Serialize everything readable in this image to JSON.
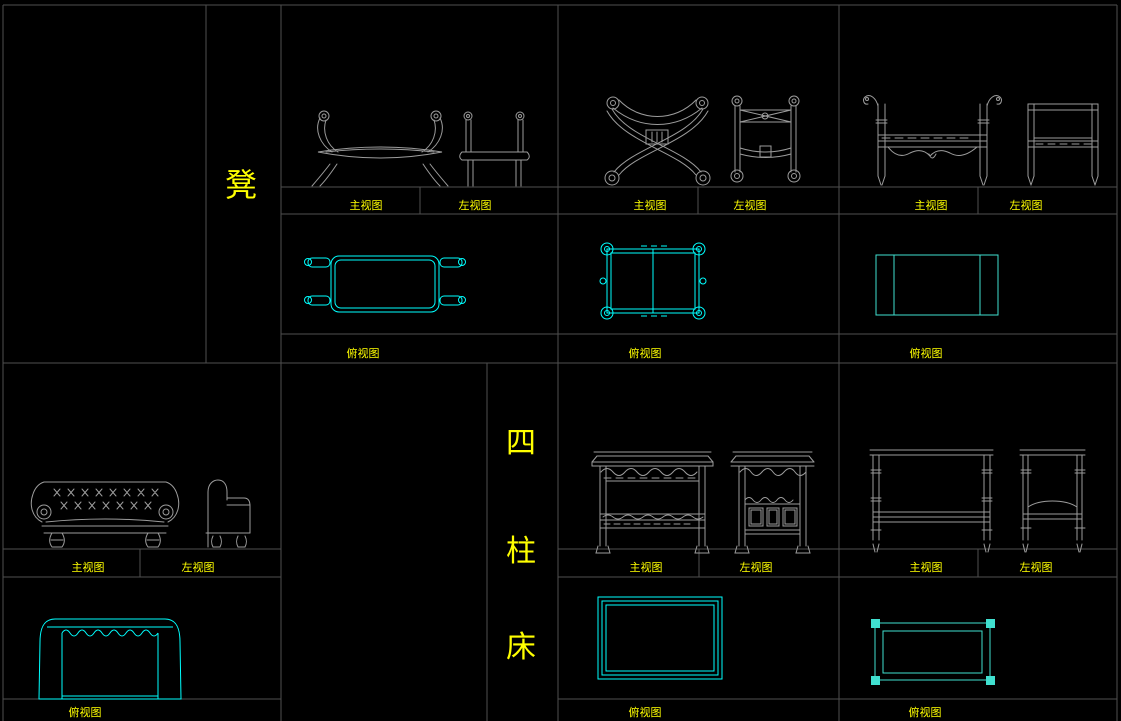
{
  "canvas": {
    "width": 1121,
    "height": 721
  },
  "palette": {
    "background": "#000000",
    "grid_line": "#4f4f4f",
    "drawing_line": "#9c9c9c",
    "top_view_cyan": "#00ffff",
    "top_view_teal": "#40e0d0",
    "label_yellow": "#ffff00"
  },
  "categories": {
    "stool_label": "凳",
    "four_poster_bed_label": "四柱床",
    "four_poster_bed_chars": [
      "四",
      "柱",
      "床"
    ]
  },
  "view_labels": {
    "front": "主视图",
    "left": "左视图",
    "top": "俯视图"
  }
}
